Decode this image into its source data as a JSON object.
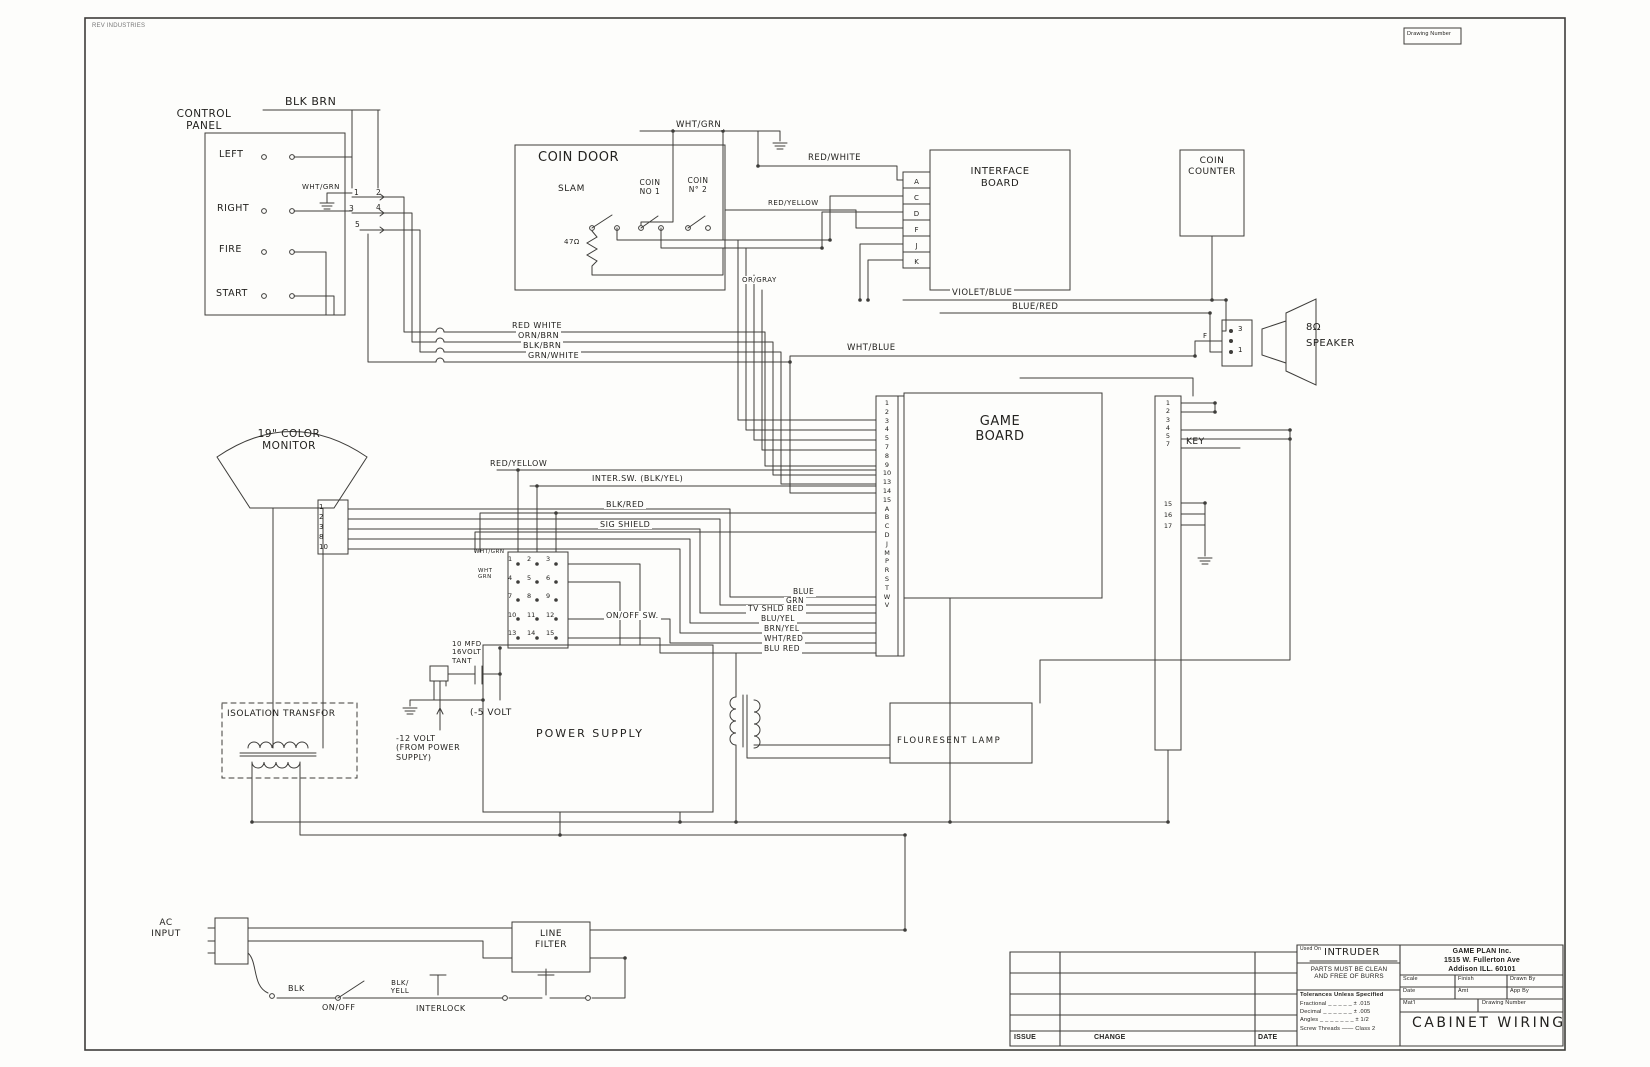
{
  "page": {
    "stamp": "REV INDUSTRIES",
    "drawing_number_label": "Drawing Number"
  },
  "control_panel": {
    "title": "CONTROL\nPANEL",
    "blk_brn": "BLK BRN",
    "sw_left": "LEFT",
    "sw_right": "RIGHT",
    "sw_fire": "FIRE",
    "sw_start": "START",
    "wht_grn": "WHT/GRN",
    "pins": [
      "1",
      "2",
      "3",
      "4",
      "5"
    ]
  },
  "coin_door": {
    "title": "COIN DOOR",
    "slam": "SLAM",
    "coin1": "COIN\nNO 1",
    "coin2": "COIN\nN° 2",
    "resistor": "47Ω"
  },
  "wire_labels": {
    "wht_grn_top": "WHT/GRN",
    "red_white": "RED/WHITE",
    "red_yellow_top": "RED/YELLOW",
    "or_gray": "OR/GRAY",
    "violet_blue": "VIOLET/BLUE",
    "blue_red": "BLUE/RED",
    "wht_blue": "WHT/BLUE",
    "red_white2": "RED WHITE",
    "orn_brn": "ORN/BRN",
    "blk_brn": "BLK/BRN",
    "grn_white": "GRN/WHITE",
    "red_yellow_mid": "RED/YELLOW",
    "inter_sw": "INTER.SW. (BLK/YEL)",
    "blk_red": "BLK/RED",
    "sig_shield": "SIG SHIELD",
    "blue": "BLUE",
    "grn": "GRN",
    "tv_shld_red": "TV SHLD RED",
    "blu_yel": "BLU/YEL",
    "brn_yel": "BRN/YEL",
    "wht_red": "WHT/RED",
    "blu_red": "BLU RED",
    "on_off_sw": "ON/OFF SW.",
    "blk": "BLK",
    "blk_yell": "BLK/\nYELL",
    "on_off": "ON/OFF",
    "interlock": "INTERLOCK"
  },
  "interface_board": {
    "title": "INTERFACE\nBOARD",
    "pins": [
      "A",
      "C",
      "D",
      "F",
      "J",
      "K"
    ]
  },
  "coin_counter": {
    "title": "COIN\nCOUNTER"
  },
  "speaker": {
    "impedance": "8Ω",
    "name": "SPEAKER",
    "pin_top": "3",
    "pin_mid": "F",
    "pin_bottom": "1"
  },
  "game_board": {
    "title": "GAME\nBOARD",
    "left_pins": [
      "1",
      "2",
      "3",
      "4",
      "5",
      "7",
      "8",
      "9",
      "10",
      "13",
      "14",
      "15",
      "A",
      "B",
      "C",
      "D",
      "J",
      "M",
      "P",
      "R",
      "S",
      "T",
      "W",
      "V"
    ],
    "key": "KEY",
    "right_pins_top": [
      "1",
      "2",
      "3",
      "4",
      "5",
      "7"
    ],
    "right_pins_mid": [
      "15",
      "16",
      "17"
    ]
  },
  "monitor": {
    "title": "19\" COLOR\nMONITOR",
    "pins": [
      "1",
      "2",
      "3",
      "8",
      "10"
    ]
  },
  "ps_connector": {
    "pins": [
      "1",
      "2",
      "3",
      "4",
      "5",
      "6",
      "7",
      "8",
      "9",
      "10",
      "11",
      "12",
      "13",
      "14",
      "15"
    ],
    "wht_grn_a": "WHT/GRN",
    "wht_grn_b": "WHT\nGRN"
  },
  "regulator": {
    "cap": "10 MFD\n16VOLT\n  TANT",
    "minus5": "(-5 VOLT",
    "minus12": "-12 VOLT\n(FROM POWER\n  SUPPLY)"
  },
  "power_supply": {
    "title": "POWER SUPPLY"
  },
  "isolation_transformer": {
    "title": "ISOLATION TRANSFOR"
  },
  "fluorescent_lamp": {
    "title": "FLOURESENT LAMP"
  },
  "line_filter": {
    "title": "LINE\nFILTER"
  },
  "ac_input": {
    "title": "AC\nINPUT"
  },
  "title_block": {
    "used_on_label": "Used On",
    "used_on_value": "INTRUDER",
    "notes": "PARTS MUST BE CLEAN\nAND FREE OF BURRS",
    "company": "GAME PLAN Inc.\n1515 W. Fullerton Ave\nAddison ILL.   60101",
    "scale": "Scale",
    "finish": "Finish",
    "draw_by": "Drawn By",
    "date": "Date",
    "amt": "Amt",
    "app_by": "App By",
    "tol_title": "Tolerances Unless Specified",
    "tol_fractional": "Fractional _ _ _ _ _  ± .015",
    "tol_decimal": "Decimal _ _ _ _ _ _  ± .005",
    "tol_angles": "Angles _ _ _ _ _ _ _  ± 1/2",
    "tol_screw": "Screw Threads —— Class 2",
    "matl": "Mat'l",
    "drawing_number": "Drawing Number",
    "drawing_title": "CABINET WIRING"
  },
  "issue_table": {
    "issue": "ISSUE",
    "change": "CHANGE",
    "date": "DATE"
  }
}
